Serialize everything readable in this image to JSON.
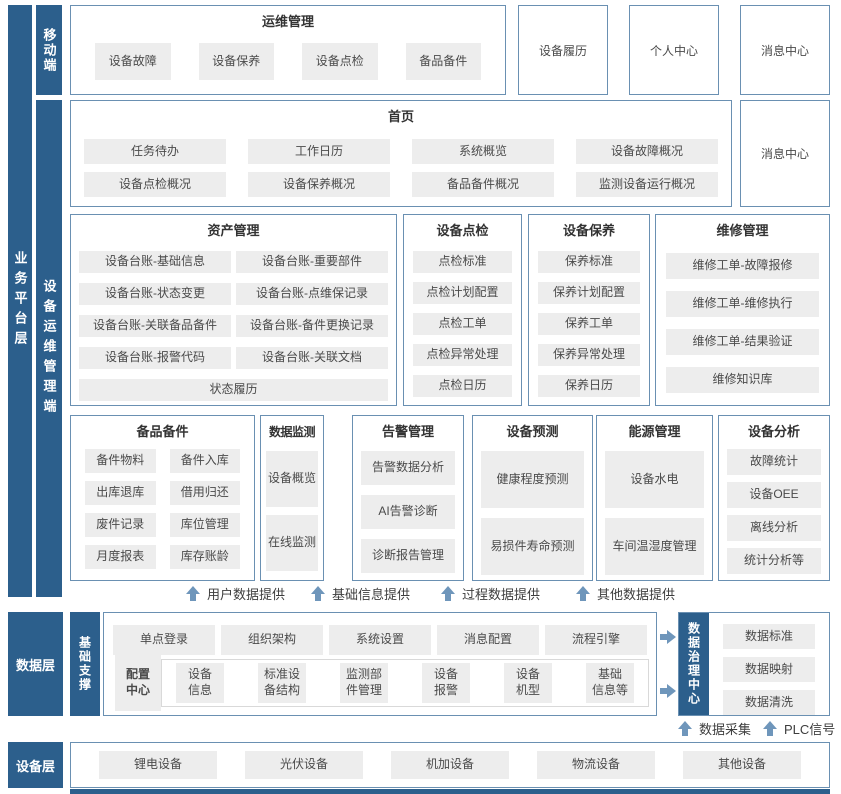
{
  "colors": {
    "navy": "#2c5f8c",
    "box_border": "#6a90b2",
    "button_bg": "#ededed",
    "arrow": "#6f96bb"
  },
  "layers": {
    "business_platform": "业务平台层",
    "mobile": "移动端",
    "device_ops": "设备运维管理端",
    "data_layer": "数据层",
    "base_support": "基础支撑",
    "data_governance": "数据治理中心",
    "device_layer": "设备层"
  },
  "mobile_section": {
    "ops": {
      "title": "运维管理",
      "items": [
        "设备故障",
        "设备保养",
        "设备点检",
        "备品备件"
      ]
    },
    "standalone": [
      "设备履历",
      "个人中心",
      "消息中心"
    ]
  },
  "home": {
    "title": "首页",
    "items": [
      "任务待办",
      "工作日历",
      "系统概览",
      "设备故障概况",
      "设备点检概况",
      "设备保养概况",
      "备品备件概况",
      "监测设备运行概况"
    ],
    "message_center": "消息中心"
  },
  "asset": {
    "title": "资产管理",
    "items": [
      "设备台账-基础信息",
      "设备台账-重要部件",
      "设备台账-状态变更",
      "设备台账-点维保记录",
      "设备台账-关联备品备件",
      "设备台账-备件更换记录",
      "设备台账-报警代码",
      "设备台账-关联文档"
    ],
    "footer_item": "状态履历"
  },
  "inspection": {
    "title": "设备点检",
    "items": [
      "点检标准",
      "点检计划配置",
      "点检工单",
      "点检异常处理",
      "点检日历"
    ]
  },
  "upkeep": {
    "title": "设备保养",
    "items": [
      "保养标准",
      "保养计划配置",
      "保养工单",
      "保养异常处理",
      "保养日历"
    ]
  },
  "repair": {
    "title": "维修管理",
    "items": [
      "维修工单-故障报修",
      "维修工单-维修执行",
      "维修工单-结果验证",
      "维修知识库"
    ]
  },
  "spare": {
    "title": "备品备件",
    "items": [
      "备件物料",
      "备件入库",
      "出库退库",
      "借用归还",
      "废件记录",
      "库位管理",
      "月度报表",
      "库存账龄"
    ]
  },
  "monitor": {
    "title": "数据监测",
    "items": [
      "设备概览",
      "在线监测"
    ]
  },
  "alarm": {
    "title": "告警管理",
    "items": [
      "告警数据分析",
      "AI告警诊断",
      "诊断报告管理"
    ]
  },
  "predict": {
    "title": "设备预测",
    "items": [
      "健康程度预测",
      "易损件寿命预测"
    ]
  },
  "energy": {
    "title": "能源管理",
    "items": [
      "设备水电",
      "车间温湿度管理"
    ]
  },
  "analysis": {
    "title": "设备分析",
    "items": [
      "故障统计",
      "设备OEE",
      "离线分析",
      "统计分析等"
    ]
  },
  "flow_up": [
    "用户数据提供",
    "基础信息提供",
    "过程数据提供",
    "其他数据提供"
  ],
  "data_section": {
    "row1": [
      "单点登录",
      "组织架构",
      "系统设置",
      "消息配置",
      "流程引擎"
    ],
    "config_center": "配置\n中心",
    "row2": [
      "设备\n信息",
      "标准设\n备结构",
      "监测部\n件管理",
      "设备\n报警",
      "设备\n机型",
      "基础\n信息等"
    ],
    "governance_items": [
      "数据标准",
      "数据映射",
      "数据清洗"
    ],
    "bottom_flows": [
      "数据采集",
      "PLC信号"
    ]
  },
  "device_section": {
    "items": [
      "锂电设备",
      "光伏设备",
      "机加设备",
      "物流设备",
      "其他设备"
    ]
  }
}
